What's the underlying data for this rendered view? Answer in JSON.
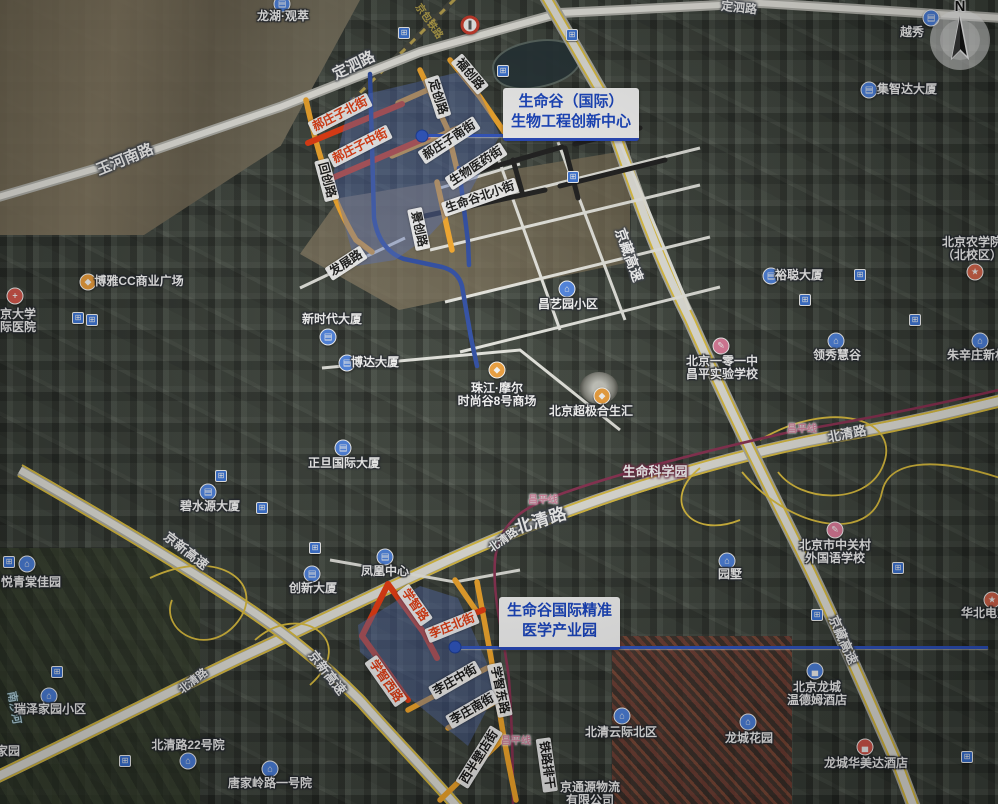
{
  "canvas": {
    "width": 998,
    "height": 804
  },
  "colors": {
    "highlight_red": "#f23a0e",
    "highlight_yellow": "#ffae2a",
    "route_blue": "#2c4ca8",
    "area_overlay_blue": "rgba(88,116,198,0.42)",
    "callout_blue": "#1443c8",
    "metro_line_pink": "#8e2f52",
    "highway_yellow": "#e6c63e"
  },
  "callouts": {
    "innovation": {
      "line1": "生命谷（国际）",
      "line2": "生物工程创新中心"
    },
    "medical": {
      "line1": "生命谷国际精准",
      "line2": "医学产业园"
    }
  },
  "compass": {
    "letter": "N"
  },
  "icon_styles": {
    "building": {
      "glyph": "▤",
      "bg": "#4e86e8"
    },
    "house": {
      "glyph": "⌂",
      "bg": "#4e86e8"
    },
    "hotel": {
      "glyph": "▄",
      "bg": "#4e86e8"
    },
    "hotel_red": {
      "glyph": "▄",
      "bg": "#e05a4e"
    },
    "shop": {
      "glyph": "◆",
      "bg": "#f5a33b"
    },
    "hospital": {
      "glyph": "+",
      "bg": "#e05a4e"
    },
    "school_pink": {
      "glyph": "✎",
      "bg": "#e87fa0"
    },
    "school_red": {
      "glyph": "★",
      "bg": "#e0694e"
    }
  },
  "road_labels": [
    {
      "t": "玉河南路",
      "x": 125,
      "y": 160,
      "r": -22,
      "c": "road",
      "s": 15
    },
    {
      "t": "定泗路",
      "x": 354,
      "y": 66,
      "r": -26,
      "c": "road",
      "s": 15
    },
    {
      "t": "定泗路",
      "x": 739,
      "y": 8,
      "r": 6,
      "c": "road",
      "s": 12
    },
    {
      "t": "京藏高速",
      "x": 629,
      "y": 255,
      "r": 70,
      "c": "road",
      "s": 14
    },
    {
      "t": "京藏高速",
      "x": 843,
      "y": 640,
      "r": 66,
      "c": "road",
      "s": 13
    },
    {
      "t": "京新高速",
      "x": 186,
      "y": 551,
      "r": 38,
      "c": "road",
      "s": 13
    },
    {
      "t": "京新高速",
      "x": 327,
      "y": 673,
      "r": 52,
      "c": "road",
      "s": 13
    },
    {
      "t": "北清路",
      "x": 541,
      "y": 521,
      "r": -17,
      "c": "road-big",
      "s": 17
    },
    {
      "t": "北清路",
      "x": 504,
      "y": 541,
      "r": -35,
      "c": "road",
      "s": 11
    },
    {
      "t": "北清路",
      "x": 847,
      "y": 434,
      "r": -11,
      "c": "road",
      "s": 13
    },
    {
      "t": "北清路",
      "x": 194,
      "y": 682,
      "r": -38,
      "c": "road",
      "s": 11
    },
    {
      "t": "生命科学园",
      "x": 655,
      "y": 472,
      "r": 0,
      "c": "park",
      "s": 13
    },
    {
      "t": "昌平线",
      "x": 543,
      "y": 501,
      "r": 0,
      "c": "metro",
      "s": 10
    },
    {
      "t": "昌平线",
      "x": 802,
      "y": 430,
      "r": 0,
      "c": "metro",
      "s": 10
    },
    {
      "t": "昌平线",
      "x": 516,
      "y": 742,
      "r": 0,
      "c": "metro",
      "s": 10
    },
    {
      "t": "京包铁路",
      "x": 428,
      "y": 22,
      "r": 55,
      "c": "rail",
      "s": 10
    },
    {
      "t": "南沙河",
      "x": 13,
      "y": 708,
      "r": 80,
      "c": "river",
      "s": 11
    },
    {
      "t": "回创路",
      "x": 327,
      "y": 180,
      "r": 75,
      "c": "chip"
    },
    {
      "t": "定创路",
      "x": 438,
      "y": 97,
      "r": 72,
      "c": "chip"
    },
    {
      "t": "福创路",
      "x": 470,
      "y": 74,
      "r": 50,
      "c": "chip"
    },
    {
      "t": "景创路",
      "x": 419,
      "y": 229,
      "r": 78,
      "c": "chip"
    },
    {
      "t": "发展路",
      "x": 346,
      "y": 263,
      "r": -33,
      "c": "chip"
    },
    {
      "t": "郝庄子南街",
      "x": 449,
      "y": 140,
      "r": -33,
      "c": "chip"
    },
    {
      "t": "生物医药街",
      "x": 476,
      "y": 166,
      "r": -33,
      "c": "chip"
    },
    {
      "t": "生命谷北小街",
      "x": 480,
      "y": 197,
      "r": -19,
      "c": "chip"
    },
    {
      "t": "李庄中街",
      "x": 455,
      "y": 680,
      "r": -30,
      "c": "chip"
    },
    {
      "t": "学智东路",
      "x": 500,
      "y": 690,
      "r": 78,
      "c": "chip"
    },
    {
      "t": "李庄南街",
      "x": 472,
      "y": 709,
      "r": -30,
      "c": "chip"
    },
    {
      "t": "西半壁店街",
      "x": 479,
      "y": 757,
      "r": -58,
      "c": "chip"
    },
    {
      "t": "铁路排干",
      "x": 547,
      "y": 765,
      "r": 82,
      "c": "chip"
    },
    {
      "t": "郝庄子北街",
      "x": 340,
      "y": 114,
      "r": -27,
      "c": "chip-red"
    },
    {
      "t": "郝庄子中街",
      "x": 360,
      "y": 146,
      "r": -27,
      "c": "chip-red"
    },
    {
      "t": "学智路",
      "x": 415,
      "y": 605,
      "r": 55,
      "c": "chip-red"
    },
    {
      "t": "李庄北街",
      "x": 452,
      "y": 626,
      "r": -22,
      "c": "chip-red"
    },
    {
      "t": "学智西路",
      "x": 386,
      "y": 681,
      "r": 55,
      "c": "chip-red"
    }
  ],
  "pois": [
    {
      "lines": [
        "龙湖·观萃"
      ],
      "x": 283,
      "y": 17,
      "icon": {
        "t": "building",
        "x": 282,
        "y": 4
      }
    },
    {
      "lines": [
        "越秀"
      ],
      "x": 912,
      "y": 33,
      "icon": {
        "t": "building",
        "x": 931,
        "y": 18
      }
    },
    {
      "lines": [
        "集智达大厦"
      ],
      "x": 907,
      "y": 90,
      "icon": {
        "t": "building",
        "x": 869,
        "y": 90
      }
    },
    {
      "lines": [
        "北京农学院",
        "（北校区）"
      ],
      "x": 972,
      "y": 243,
      "icon": {
        "t": "school_red",
        "x": 975,
        "y": 272
      }
    },
    {
      "lines": [
        "裕聪大厦"
      ],
      "x": 799,
      "y": 276,
      "icon": {
        "t": "building",
        "x": 771,
        "y": 276
      }
    },
    {
      "lines": [
        "领秀慧谷"
      ],
      "x": 837,
      "y": 356,
      "icon": {
        "t": "house",
        "x": 836,
        "y": 341
      }
    },
    {
      "lines": [
        "朱辛庄新村"
      ],
      "x": 977,
      "y": 356,
      "icon": {
        "t": "house",
        "x": 980,
        "y": 341
      }
    },
    {
      "lines": [
        "北京一零一中",
        "昌平实验学校"
      ],
      "x": 722,
      "y": 362,
      "icon": {
        "t": "school_pink",
        "x": 721,
        "y": 346
      }
    },
    {
      "lines": [
        "博雅CC商业广场"
      ],
      "x": 139,
      "y": 282,
      "icon": {
        "t": "shop",
        "x": 88,
        "y": 282
      }
    },
    {
      "lines": [
        "北京大学",
        "国际医院"
      ],
      "x": 12,
      "y": 315,
      "icon": {
        "t": "hospital",
        "x": 15,
        "y": 296
      }
    },
    {
      "lines": [
        "新时代大厦"
      ],
      "x": 332,
      "y": 320,
      "icon": {
        "t": "building",
        "x": 328,
        "y": 337
      }
    },
    {
      "lines": [
        "博达大厦"
      ],
      "x": 375,
      "y": 363,
      "icon": {
        "t": "building",
        "x": 347,
        "y": 363
      }
    },
    {
      "lines": [
        "昌艺园小区"
      ],
      "x": 568,
      "y": 305,
      "icon": {
        "t": "house",
        "x": 567,
        "y": 289
      }
    },
    {
      "lines": [
        "珠江·摩尔",
        "时尚谷8号商场"
      ],
      "x": 497,
      "y": 389,
      "icon": {
        "t": "shop",
        "x": 497,
        "y": 370
      }
    },
    {
      "lines": [
        "北京超极合生汇"
      ],
      "x": 591,
      "y": 412,
      "icon": {
        "t": "shop",
        "x": 602,
        "y": 396
      }
    },
    {
      "lines": [
        "正旦国际大厦"
      ],
      "x": 344,
      "y": 464,
      "icon": {
        "t": "building",
        "x": 343,
        "y": 448
      }
    },
    {
      "lines": [
        "碧水源大厦"
      ],
      "x": 210,
      "y": 507,
      "icon": {
        "t": "building",
        "x": 208,
        "y": 492
      }
    },
    {
      "lines": [
        "凤凰中心"
      ],
      "x": 385,
      "y": 572,
      "icon": {
        "t": "building",
        "x": 385,
        "y": 557
      }
    },
    {
      "lines": [
        "创新大厦"
      ],
      "x": 313,
      "y": 589,
      "icon": {
        "t": "building",
        "x": 312,
        "y": 574
      }
    },
    {
      "lines": [
        "园墅"
      ],
      "x": 730,
      "y": 575,
      "icon": {
        "t": "house",
        "x": 727,
        "y": 561
      }
    },
    {
      "lines": [
        "北京市中关村",
        "外国语学校"
      ],
      "x": 835,
      "y": 546,
      "icon": {
        "t": "school_pink",
        "x": 835,
        "y": 530
      }
    },
    {
      "lines": [
        "华北电力"
      ],
      "x": 985,
      "y": 614,
      "icon": {
        "t": "school_red",
        "x": 992,
        "y": 600
      }
    },
    {
      "lines": [
        "悦青棠佳园"
      ],
      "x": 31,
      "y": 583,
      "icon": {
        "t": "house",
        "x": 27,
        "y": 564
      }
    },
    {
      "lines": [
        "瑞泽家园小区"
      ],
      "x": 50,
      "y": 710,
      "icon": {
        "t": "house",
        "x": 49,
        "y": 696
      }
    },
    {
      "lines": [
        "家园"
      ],
      "x": 8,
      "y": 752
    },
    {
      "lines": [
        "北清路22号院"
      ],
      "x": 188,
      "y": 746,
      "icon": {
        "t": "house",
        "x": 188,
        "y": 761
      }
    },
    {
      "lines": [
        "唐家岭路一号院"
      ],
      "x": 270,
      "y": 784,
      "icon": {
        "t": "house",
        "x": 270,
        "y": 769
      }
    },
    {
      "lines": [
        "北清云际北区"
      ],
      "x": 621,
      "y": 733,
      "icon": {
        "t": "house",
        "x": 622,
        "y": 716
      }
    },
    {
      "lines": [
        "龙城花园"
      ],
      "x": 749,
      "y": 739,
      "icon": {
        "t": "house",
        "x": 748,
        "y": 722
      }
    },
    {
      "lines": [
        "北京龙城",
        "温德姆酒店"
      ],
      "x": 817,
      "y": 688,
      "icon": {
        "t": "hotel",
        "x": 815,
        "y": 671
      }
    },
    {
      "lines": [
        "龙城华美达酒店"
      ],
      "x": 866,
      "y": 764,
      "icon": {
        "t": "hotel_red",
        "x": 865,
        "y": 747
      }
    },
    {
      "lines": [
        "京通源物流",
        "有限公司"
      ],
      "x": 590,
      "y": 788
    }
  ],
  "station_icons": [
    [
      404,
      33
    ],
    [
      572,
      35
    ],
    [
      503,
      71
    ],
    [
      573,
      177
    ],
    [
      78,
      318
    ],
    [
      92,
      320
    ],
    [
      262,
      508
    ],
    [
      221,
      476
    ],
    [
      315,
      548
    ],
    [
      860,
      275
    ],
    [
      805,
      300
    ],
    [
      915,
      320
    ],
    [
      898,
      568
    ],
    [
      817,
      615
    ],
    [
      967,
      757
    ],
    [
      57,
      672
    ],
    [
      125,
      761
    ],
    [
      9,
      562
    ]
  ],
  "traffic_sign": {
    "x": 470,
    "y": 25
  }
}
